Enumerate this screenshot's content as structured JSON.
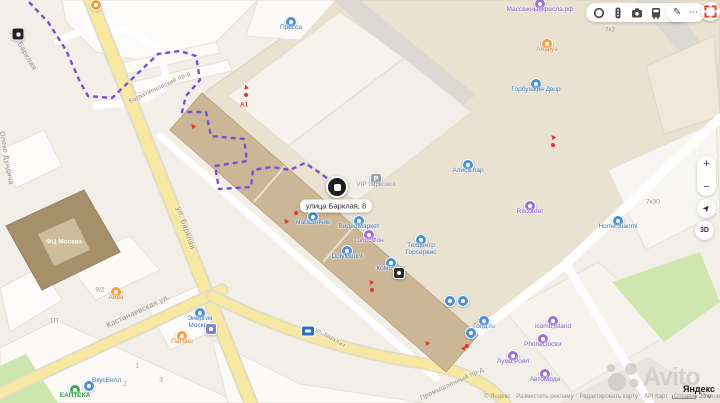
{
  "pin": {
    "label": "улица Барклая, 8"
  },
  "toolbar": {
    "icons": [
      "route-ring-icon",
      "traffic-icon",
      "camera-icon",
      "transit-icon",
      "panorama-icon"
    ],
    "edit_glyph": "✎",
    "more_glyph": "⋯"
  },
  "map_controls": {
    "zoom_in": "+",
    "zoom_out": "−",
    "locate_glyph": "➤",
    "tilt_label": "3D"
  },
  "watermark": {
    "brand": "Avito"
  },
  "yandex_logo": "Яндекс",
  "attribution": {
    "copyright": "© Яндекс",
    "links": [
      "Разместить рекламу",
      "Редактировать карту",
      "API Карт",
      "Справка",
      "Условия использования"
    ],
    "scale": "20 м"
  },
  "streets": [
    {
      "label": "ул. Барклая",
      "x": 24,
      "y": 50,
      "rot": 60,
      "s": 7.5
    },
    {
      "label": "Олеко Дундича",
      "x": 6,
      "y": 158,
      "rot": 80,
      "s": 7
    },
    {
      "label": "ул. Барклая",
      "x": 186,
      "y": 228,
      "rot": 71,
      "s": 7.5
    },
    {
      "label": "Кастанаевская ул.",
      "x": 138,
      "y": 311,
      "rot": -25,
      "s": 7.5
    },
    {
      "label": "Багратионовский пр-д",
      "x": 160,
      "y": 88,
      "rot": -25,
      "s": 6
    },
    {
      "label": "Промышленный пр-д",
      "x": 452,
      "y": 384,
      "rot": -25,
      "s": 6.5
    },
    {
      "label": "ул. Барклая",
      "x": 330,
      "y": 338,
      "rot": 30,
      "s": 5.5
    }
  ],
  "pois": [
    {
      "label": "Пресса",
      "c": "blue",
      "x": 291,
      "y": 22
    },
    {
      "label": "Массажныекресла.рф",
      "c": "purple",
      "x": 540,
      "y": 4
    },
    {
      "label": "Amaiya",
      "c": "orange",
      "x": 547,
      "y": 44
    },
    {
      "label": "Горбушкин Двор",
      "c": "blue",
      "x": 536,
      "y": 84
    },
    {
      "label": "Алиса пар",
      "c": "blue",
      "x": 468,
      "y": 165
    },
    {
      "label": "Recorder",
      "c": "purple",
      "x": 530,
      "y": 206
    },
    {
      "label": "Home Xiaomi",
      "c": "blue",
      "x": 618,
      "y": 221
    },
    {
      "label": "Техцентр Горсервис",
      "c": "blue",
      "x": 421,
      "y": 240,
      "w": 44
    },
    {
      "label": "магазинчик",
      "c": "blue",
      "x": 313,
      "y": 217
    },
    {
      "label": "ВидеоМаркет",
      "c": "blue",
      "x": 359,
      "y": 221
    },
    {
      "label": "ГолосФон",
      "c": "purple",
      "x": 369,
      "y": 235
    },
    {
      "label": "DolyMount",
      "c": "blue",
      "x": 347,
      "y": 251
    },
    {
      "label": "КомБудет",
      "c": "blue",
      "x": 391,
      "y": 263
    },
    {
      "label": "",
      "c": "black",
      "x": 399,
      "y": 273,
      "shape": "square"
    },
    {
      "label": "",
      "c": "blue",
      "x": 450,
      "y": 301
    },
    {
      "label": "",
      "c": "blue",
      "x": 463,
      "y": 301
    },
    {
      "label": "Голд.ru",
      "c": "blue",
      "x": 484,
      "y": 321
    },
    {
      "label": "",
      "c": "blue",
      "x": 471,
      "y": 333
    },
    {
      "label": "icomb island",
      "c": "purple",
      "x": 553,
      "y": 321
    },
    {
      "label": "PhoneDoctor",
      "c": "purple",
      "x": 543,
      "y": 339
    },
    {
      "label": "Лума Роял",
      "c": "purple",
      "x": 513,
      "y": 356
    },
    {
      "label": "АвтоМода",
      "c": "purple",
      "x": 545,
      "y": 374
    },
    {
      "label": "Айва",
      "c": "orange",
      "x": 116,
      "y": 292
    },
    {
      "label": "Энергия Москвы",
      "c": "blue",
      "x": 200,
      "y": 313,
      "w": 42
    },
    {
      "label": "ПаПаш",
      "c": "orange",
      "x": 182,
      "y": 336
    },
    {
      "label": "",
      "c": "slate",
      "x": 211,
      "y": 329,
      "shape": "square"
    },
    {
      "label": "ЕАПТЕКА",
      "c": "green",
      "x": 75,
      "y": 390
    },
    {
      "label": "ВкусВилл",
      "c": "blue",
      "x": 89,
      "y": 386,
      "side": true
    },
    {
      "label": "",
      "c": "orange",
      "x": 96,
      "y": 5
    },
    {
      "label": "VIP парковка",
      "c": "gray",
      "x": 376,
      "y": 179,
      "shape": "square",
      "glyph": "P",
      "label_class": "lc-gray"
    }
  ],
  "numbers": [
    {
      "t": "7к3",
      "x": 610,
      "y": 30
    },
    {
      "t": "7к30",
      "x": 653,
      "y": 202
    },
    {
      "t": "9/2",
      "x": 100,
      "y": 290
    },
    {
      "t": "1П",
      "x": 54,
      "y": 321
    },
    {
      "t": "2",
      "x": 125,
      "y": 384
    },
    {
      "t": "1",
      "x": 137,
      "y": 366
    },
    {
      "t": "3",
      "x": 161,
      "y": 380
    },
    {
      "t": "А1",
      "x": 244,
      "y": 105,
      "cls": "red"
    },
    {
      "t": "ФЦ Москва",
      "x": 64,
      "y": 242,
      "cls": "white"
    }
  ],
  "entrance_arrows": [
    {
      "x": 193,
      "y": 126,
      "rot": -40
    },
    {
      "x": 286,
      "y": 221,
      "rot": -40
    },
    {
      "x": 371,
      "y": 282,
      "rot": -40
    },
    {
      "x": 427,
      "y": 343,
      "rot": -40
    },
    {
      "x": 464,
      "y": 348,
      "rot": 35
    },
    {
      "x": 553,
      "y": 137,
      "rot": -40
    },
    {
      "x": 246,
      "y": 87,
      "rot": -15
    }
  ],
  "entrance_dots": [
    {
      "x": 246,
      "y": 95
    },
    {
      "x": 296,
      "y": 213
    },
    {
      "x": 372,
      "y": 290
    },
    {
      "x": 467,
      "y": 346
    },
    {
      "x": 553,
      "y": 145
    }
  ],
  "arrow_glyph": "▲"
}
